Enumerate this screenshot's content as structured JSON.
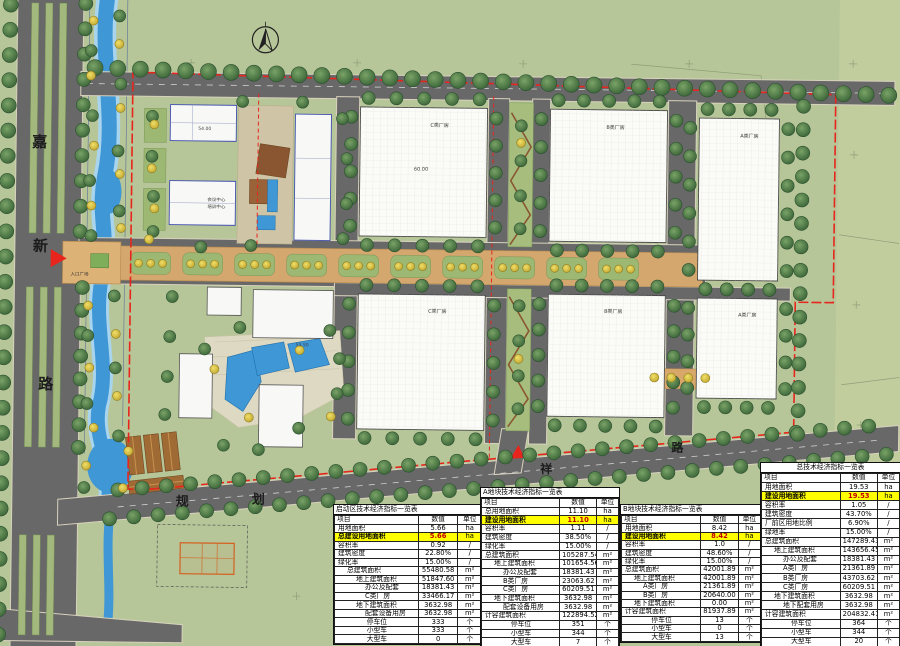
{
  "map": {
    "road_labels": [
      {
        "t": "嘉",
        "x": 30,
        "y": 152,
        "s": 15
      },
      {
        "t": "新",
        "x": 32,
        "y": 256,
        "s": 15
      },
      {
        "t": "路",
        "x": 39,
        "y": 394,
        "s": 15
      },
      {
        "t": "规",
        "x": 178,
        "y": 509,
        "s": 13
      },
      {
        "t": "划",
        "x": 254,
        "y": 506,
        "s": 13
      },
      {
        "t": "祥",
        "x": 542,
        "y": 472,
        "s": 12
      },
      {
        "t": "路",
        "x": 673,
        "y": 449,
        "s": 12
      }
    ],
    "site_labels": [
      {
        "t": "C类厂房",
        "x": 428,
        "y": 127,
        "s": 5
      },
      {
        "t": "B类厂房",
        "x": 604,
        "y": 127,
        "s": 5
      },
      {
        "t": "A类厂房",
        "x": 738,
        "y": 134,
        "s": 5
      },
      {
        "t": "C类厂房",
        "x": 428,
        "y": 313,
        "s": 5
      },
      {
        "t": "B类厂房",
        "x": 604,
        "y": 311,
        "s": 5
      },
      {
        "t": "A类厂房",
        "x": 738,
        "y": 313,
        "s": 5
      },
      {
        "t": "会议中心",
        "x": 206,
        "y": 204,
        "s": 4.5
      },
      {
        "t": "培训中心",
        "x": 206,
        "y": 211,
        "s": 4.5
      },
      {
        "t": "入口广场",
        "x": 70,
        "y": 280,
        "s": 4.5
      }
    ],
    "dim_labels": [
      {
        "t": "60.00",
        "x": 412,
        "y": 171,
        "s": 5
      },
      {
        "t": "54.00",
        "x": 196,
        "y": 133,
        "s": 4.5
      },
      {
        "t": "53.50",
        "x": 296,
        "y": 348,
        "s": 4.5
      }
    ],
    "colors": {
      "ground": "#b7c698",
      "road": "#686868",
      "water": "#3f97d6",
      "boundary_red": "#e8251c",
      "tree_green": "#4e7b46",
      "tree_yellow": "#ddc83f",
      "plaza_tan": "#d3a76e",
      "highlight": "#ffff00"
    }
  },
  "tables": [
    {
      "title": "启动区技术经济指标一览表",
      "center": false,
      "x": 333,
      "y": 504,
      "w": 148,
      "h": 139,
      "columns": [
        "项目",
        "数值",
        "单位"
      ],
      "rows": [
        {
          "l": "用地面积",
          "v": "5.66",
          "u": "ha",
          "i": 0
        },
        {
          "l": "总建设用地面积",
          "v": "5.66",
          "u": "ha",
          "i": 0,
          "hl": true
        },
        {
          "l": "容积率",
          "v": "0.92",
          "u": "/",
          "i": 0
        },
        {
          "l": "建筑密度",
          "v": "22.80%",
          "u": "/",
          "i": 0
        },
        {
          "l": "绿化率",
          "v": "15.00%",
          "u": "/",
          "i": 0
        },
        {
          "l": "总建筑面积",
          "v": "55480.58",
          "u": "m²",
          "i": 1
        },
        {
          "l": "地上建筑面积",
          "v": "51847.60",
          "u": "m²",
          "i": 2
        },
        {
          "l": "办公及配套",
          "v": "18381.43",
          "u": "m²",
          "i": 3
        },
        {
          "l": "C类厂房",
          "v": "33466.17",
          "u": "m²",
          "i": 3
        },
        {
          "l": "地下建筑面积",
          "v": "3632.98",
          "u": "m²",
          "i": 2
        },
        {
          "l": "配套设备用房",
          "v": "3632.98",
          "u": "m²",
          "i": 3
        },
        {
          "l": "停车位",
          "v": "333",
          "u": "个",
          "c": true
        },
        {
          "l": "小型车",
          "v": "333",
          "u": "个",
          "c": true
        },
        {
          "l": "大型车",
          "v": "0",
          "u": "个",
          "c": true
        }
      ]
    },
    {
      "title": "A地块技术经济指标一览表",
      "center": false,
      "x": 480,
      "y": 487,
      "w": 138,
      "h": 159,
      "columns": [
        "项目",
        "数值",
        "单位"
      ],
      "rows": [
        {
          "l": "总用地面积",
          "v": "11.10",
          "u": "ha",
          "i": 0
        },
        {
          "l": "建设用地面积",
          "v": "11.10",
          "u": "ha",
          "i": 0,
          "hl": true
        },
        {
          "l": "容积率",
          "v": "1.11",
          "u": "/",
          "i": 0
        },
        {
          "l": "建筑密度",
          "v": "38.50%",
          "u": "/",
          "i": 0
        },
        {
          "l": "绿化率",
          "v": "15.00%",
          "u": "/",
          "i": 0
        },
        {
          "l": "总建筑面积",
          "v": "105287.54",
          "u": "m²",
          "i": 0
        },
        {
          "l": "地上建筑面积",
          "v": "101654.56",
          "u": "m²",
          "i": 1
        },
        {
          "l": "办公及配套",
          "v": "18381.43",
          "u": "m²",
          "i": 2
        },
        {
          "l": "B类厂房",
          "v": "23063.62",
          "u": "m²",
          "i": 2
        },
        {
          "l": "C类厂房",
          "v": "60209.51",
          "u": "m²",
          "i": 2
        },
        {
          "l": "地下建筑面积",
          "v": "3632.98",
          "u": "m²",
          "i": 1
        },
        {
          "l": "配套设备用房",
          "v": "3632.98",
          "u": "m²",
          "i": 2
        },
        {
          "l": "计容建筑面积",
          "v": "122894.52",
          "u": "m²",
          "i": 0
        },
        {
          "l": "停车位",
          "v": "351",
          "u": "个",
          "c": true
        },
        {
          "l": "小型车",
          "v": "344",
          "u": "个",
          "c": true
        },
        {
          "l": "大型车",
          "v": "7",
          "u": "个",
          "c": true
        }
      ]
    },
    {
      "title": "B地块技术经济指标一览表",
      "center": false,
      "x": 620,
      "y": 504,
      "w": 140,
      "h": 137,
      "columns": [
        "项目",
        "数值",
        "单位"
      ],
      "rows": [
        {
          "l": "用地面积",
          "v": "8.42",
          "u": "ha",
          "i": 0
        },
        {
          "l": "建设用地面积",
          "v": "8.42",
          "u": "ha",
          "i": 0,
          "hl": true
        },
        {
          "l": "容积率",
          "v": "1.0",
          "u": "/",
          "i": 0
        },
        {
          "l": "建筑密度",
          "v": "48.60%",
          "u": "/",
          "i": 0
        },
        {
          "l": "绿化率",
          "v": "15.00%",
          "u": "/",
          "i": 0
        },
        {
          "l": "总建筑面积",
          "v": "42001.89",
          "u": "m²",
          "i": 0
        },
        {
          "l": "地上建筑面积",
          "v": "42001.89",
          "u": "m²",
          "i": 1
        },
        {
          "l": "A类厂房",
          "v": "21361.89",
          "u": "m²",
          "i": 2
        },
        {
          "l": "B类厂房",
          "v": "20640.00",
          "u": "m²",
          "i": 2
        },
        {
          "l": "地下建筑面积",
          "v": "0.00",
          "u": "m²",
          "i": 1
        },
        {
          "l": "计容建筑面积",
          "v": "81937.89",
          "u": "m²",
          "i": 0
        },
        {
          "l": "停车位",
          "v": "13",
          "u": "个",
          "c": true
        },
        {
          "l": "小型车",
          "v": "0",
          "u": "个",
          "c": true
        },
        {
          "l": "大型车",
          "v": "13",
          "u": "个",
          "c": true
        }
      ]
    },
    {
      "title": "总技术经济指标一览表",
      "center": true,
      "x": 760,
      "y": 462,
      "w": 139,
      "h": 184,
      "columns": [
        "项目",
        "数值",
        "单位"
      ],
      "rows": [
        {
          "l": "用地面积",
          "v": "19.53",
          "u": "ha",
          "i": 0
        },
        {
          "l": "建设用地面积",
          "v": "19.53",
          "u": "ha",
          "i": 0,
          "hl": true
        },
        {
          "l": "容积率",
          "v": "1.05",
          "u": "/",
          "i": 0
        },
        {
          "l": "建筑密度",
          "v": "43.70%",
          "u": "/",
          "i": 0
        },
        {
          "l": "厂前区用地比例",
          "v": "6.90%",
          "u": "/",
          "i": 0
        },
        {
          "l": "绿地率",
          "v": "15.00%",
          "u": "/",
          "i": 0
        },
        {
          "l": "总建筑面积",
          "v": "147289.43",
          "u": "m²",
          "i": 0
        },
        {
          "l": "地上建筑面积",
          "v": "143656.45",
          "u": "m²",
          "i": 1
        },
        {
          "l": "办公及配套",
          "v": "18381.43",
          "u": "m²",
          "i": 2
        },
        {
          "l": "A类厂房",
          "v": "21361.89",
          "u": "m²",
          "i": 2
        },
        {
          "l": "B类厂房",
          "v": "43703.62",
          "u": "m²",
          "i": 2
        },
        {
          "l": "C类厂房",
          "v": "60209.51",
          "u": "m²",
          "i": 2
        },
        {
          "l": "地下建筑面积",
          "v": "3632.98",
          "u": "m²",
          "i": 1
        },
        {
          "l": "地下配套用房",
          "v": "3632.98",
          "u": "m²",
          "i": 2
        },
        {
          "l": "计容建筑面积",
          "v": "204832.41",
          "u": "m²",
          "i": 0
        },
        {
          "l": "停车位",
          "v": "364",
          "u": "个",
          "c": true
        },
        {
          "l": "小型车",
          "v": "344",
          "u": "个",
          "c": true
        },
        {
          "l": "大型车",
          "v": "20",
          "u": "个",
          "c": true
        }
      ]
    }
  ]
}
